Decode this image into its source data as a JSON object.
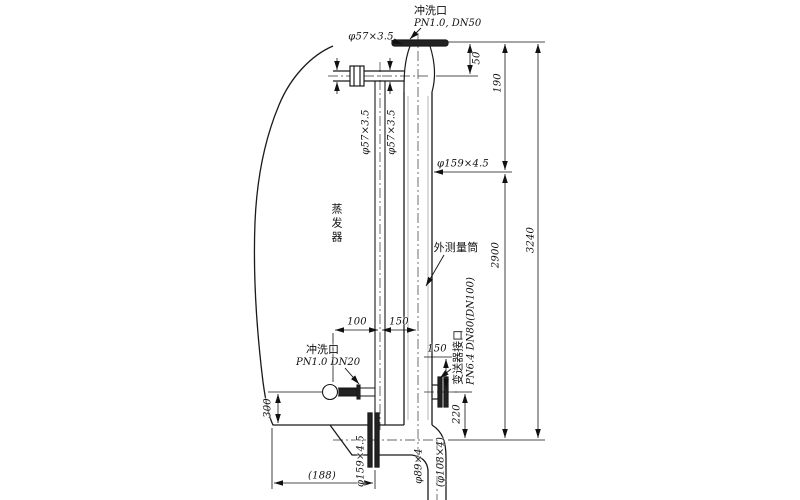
{
  "drawing": {
    "labels": {
      "top_flush_name": "冲洗口",
      "top_flush_spec": "PN1.0, DN50",
      "top_pipe_spec": "φ57×3.5",
      "horiz_pipe_spec": "φ57×3.5",
      "downcomer_spec": "φ57×3.5",
      "cylinder_spec": "φ159×4.5",
      "evaporator": "蒸发器",
      "measuring_cylinder": "外测量筒",
      "bottom_flush_name": "冲洗口",
      "bottom_flush_spec": "PN1.0 DN20",
      "transmitter_name": "变送器接口",
      "transmitter_spec": "PN6.4 DN80(DN100)",
      "bottom_pipe_spec": "φ159×4.5",
      "drain_spec": "φ89×4",
      "drain_alt_spec": "(φ108×4)"
    },
    "dimensions": {
      "flange_to_pipe": "50",
      "flange_to_level": "190",
      "level_to_bottom": "2900",
      "total_height": "3240",
      "valve_to_downcomer": "100",
      "downcomer_to_cylinder": "150",
      "tap_spacing": "150",
      "valve_height": "300",
      "port_to_bottom": "220",
      "evap_to_flange": "(188)"
    }
  }
}
